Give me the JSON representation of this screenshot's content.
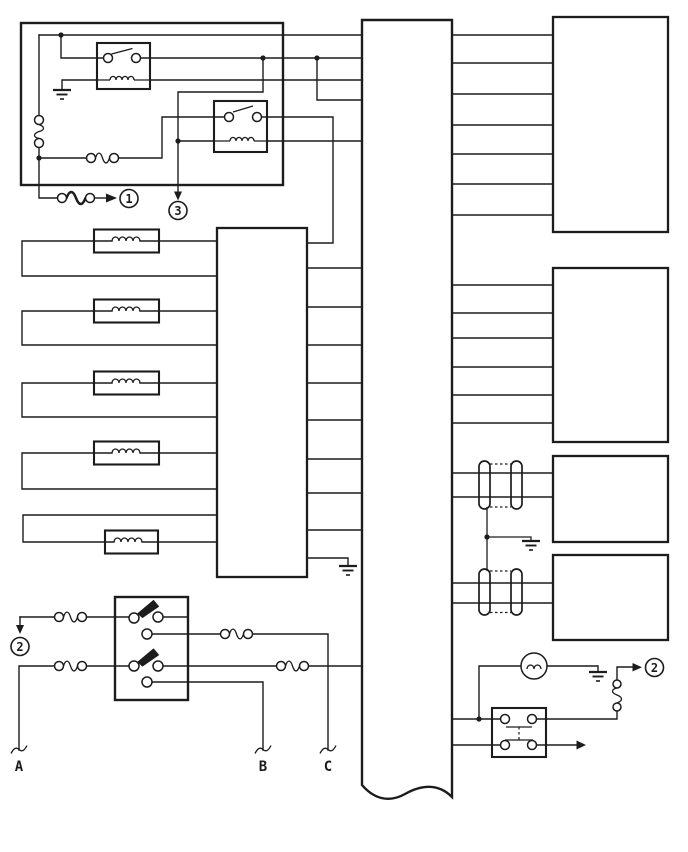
{
  "colors": {
    "line": "#1c1c1c",
    "background": "#ffffff"
  },
  "refs": {
    "ref1": "1",
    "ref3": "3",
    "ref2_left": "2",
    "ref2_right": "2"
  },
  "terminals": {
    "a": "A",
    "b": "B",
    "c": "C"
  }
}
